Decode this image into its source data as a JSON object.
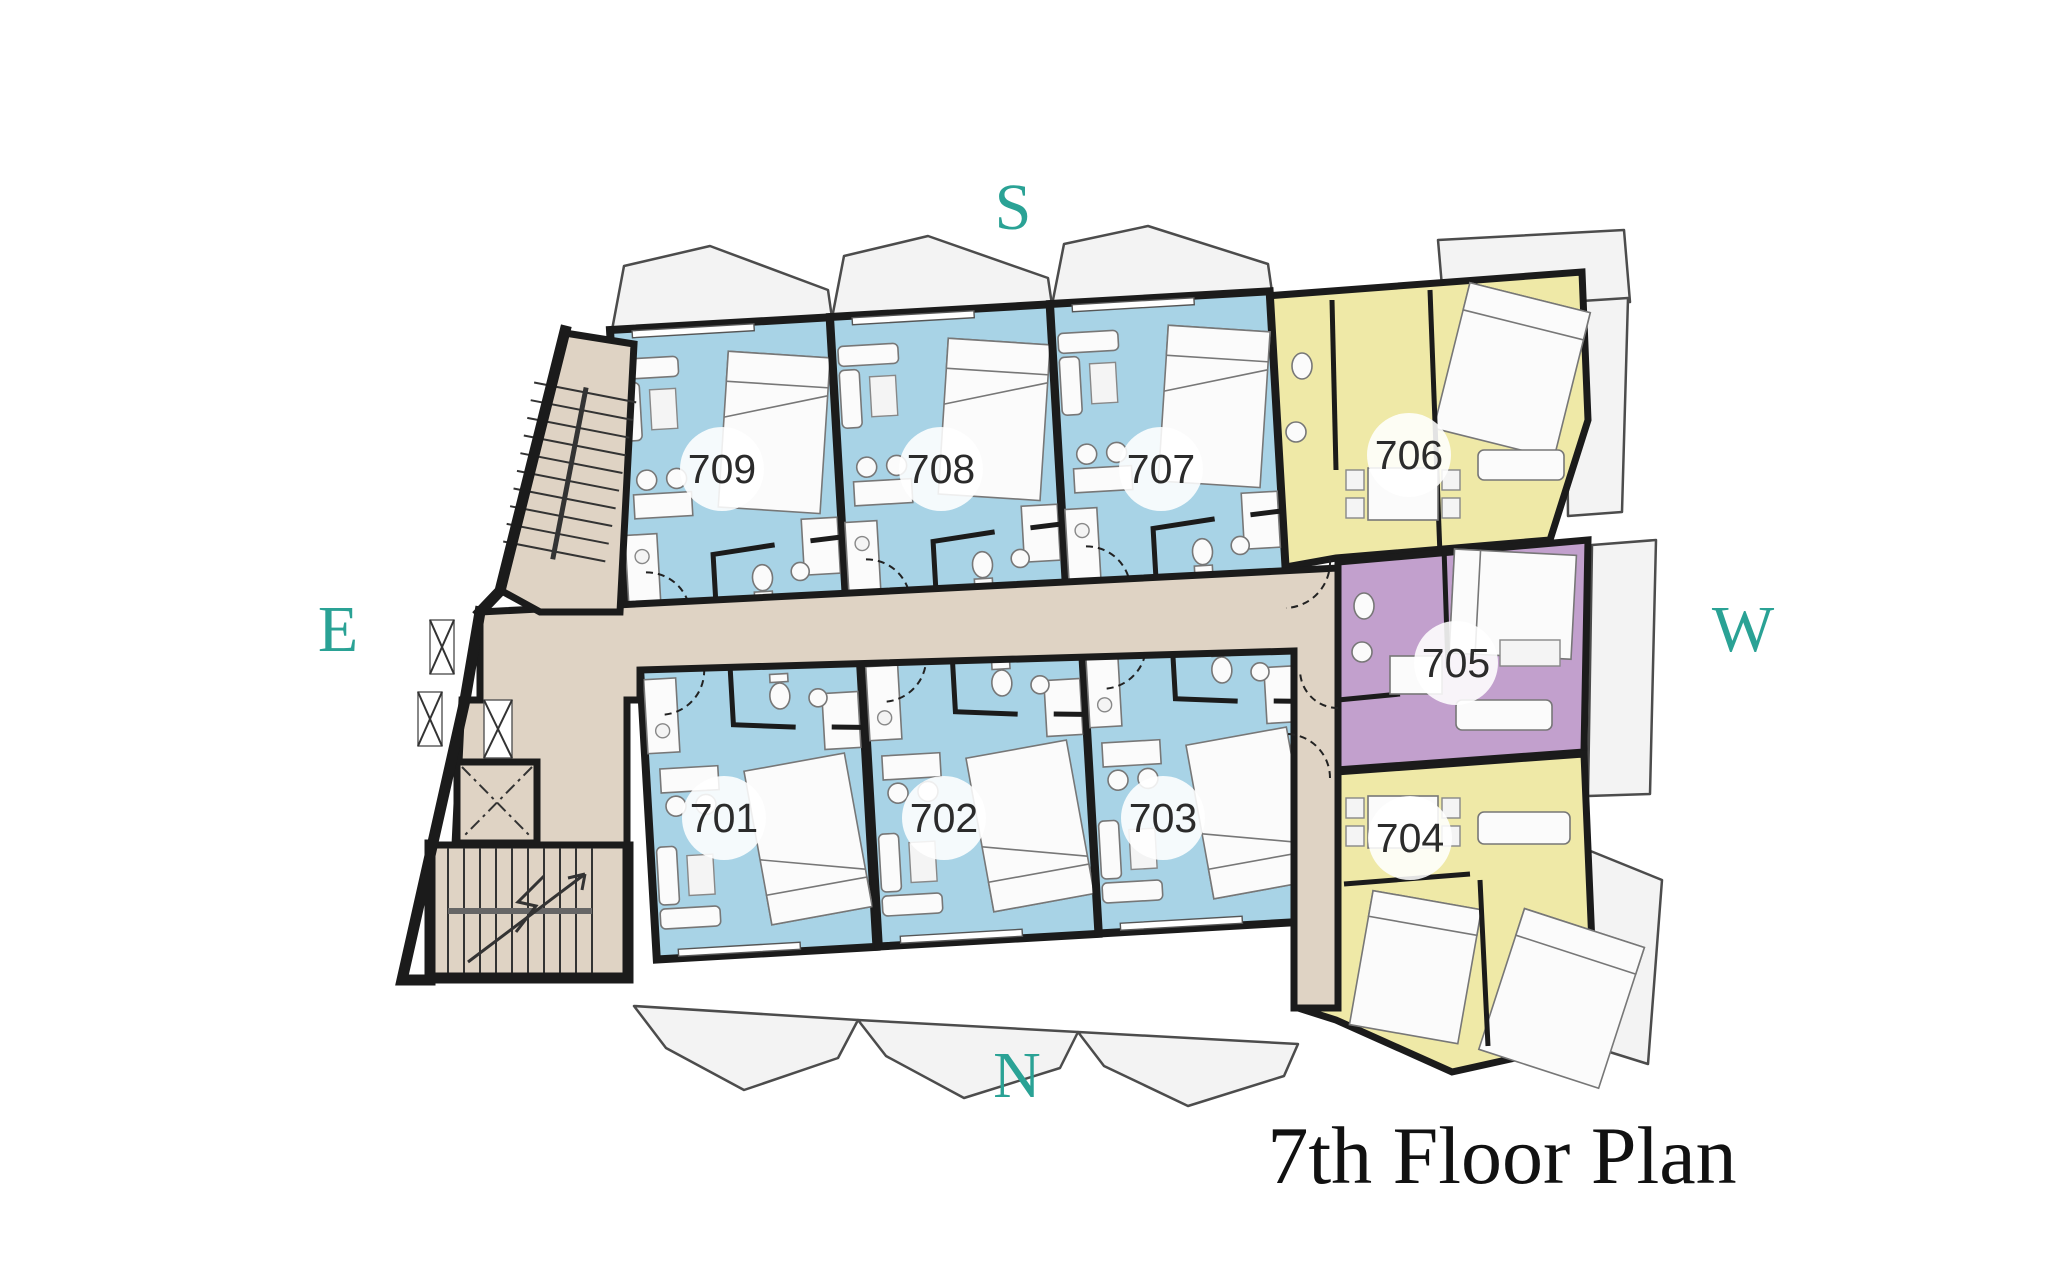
{
  "title": "7th Floor Plan",
  "compass": {
    "south": "S",
    "west": "W",
    "north": "N",
    "east": "E"
  },
  "rooms": [
    {
      "number": "701",
      "palette": "blue"
    },
    {
      "number": "702",
      "palette": "blue"
    },
    {
      "number": "703",
      "palette": "blue"
    },
    {
      "number": "704",
      "palette": "yellow"
    },
    {
      "number": "705",
      "palette": "purple"
    },
    {
      "number": "706",
      "palette": "yellow"
    },
    {
      "number": "707",
      "palette": "blue"
    },
    {
      "number": "708",
      "palette": "blue"
    },
    {
      "number": "709",
      "palette": "blue"
    }
  ],
  "colors": {
    "unit_blue": "#a8d3e6",
    "unit_yellow": "#efe9a7",
    "unit_purple": "#c2a0cd",
    "corridor": "#dfd3c4",
    "balcony": "#f3f3f3",
    "wall": "#1b1b1b",
    "compass_teal": "#2aa295",
    "title_text": "#111111",
    "room_label_text": "#2b2b2b"
  }
}
